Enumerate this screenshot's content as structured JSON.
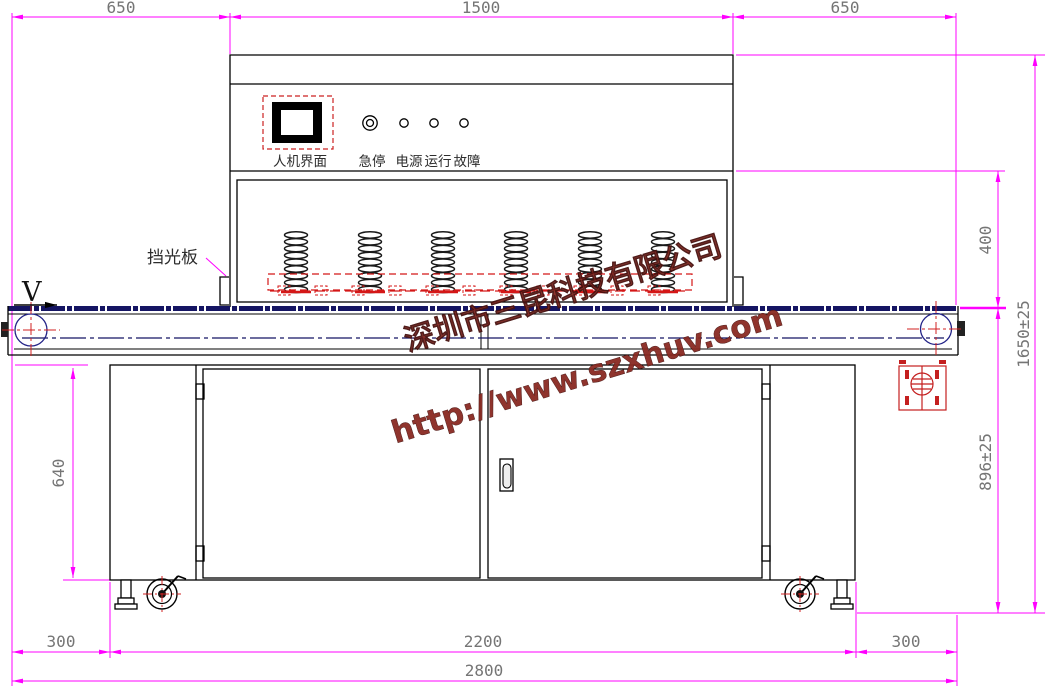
{
  "dims": {
    "top_left": "650",
    "top_center": "1500",
    "top_right": "650",
    "right_tunnel_height": "400",
    "right_belt_height": "896±25",
    "right_total_height": "1650±25",
    "left_cabinet_height": "640",
    "bottom_left_overhang": "300",
    "bottom_cabinet": "2200",
    "bottom_right_overhang": "300",
    "bottom_total": "2800"
  },
  "labels": {
    "light_shield": "挡光板",
    "belt_direction": "V",
    "hmi": "人机界面",
    "estop": "急停",
    "power": "电源",
    "run": "运行",
    "fault": "故障"
  },
  "watermark": {
    "company": "深圳市三昆科技有限公司",
    "url": "http://www.szxhuv.com"
  },
  "colors": {
    "dimension_line": "#ff00ff",
    "dimension_text": "#757575",
    "outline": "#000000",
    "conveyor_line": "#151563",
    "lamp_red": "#d41717",
    "watermark_red": "#8a2a22"
  }
}
